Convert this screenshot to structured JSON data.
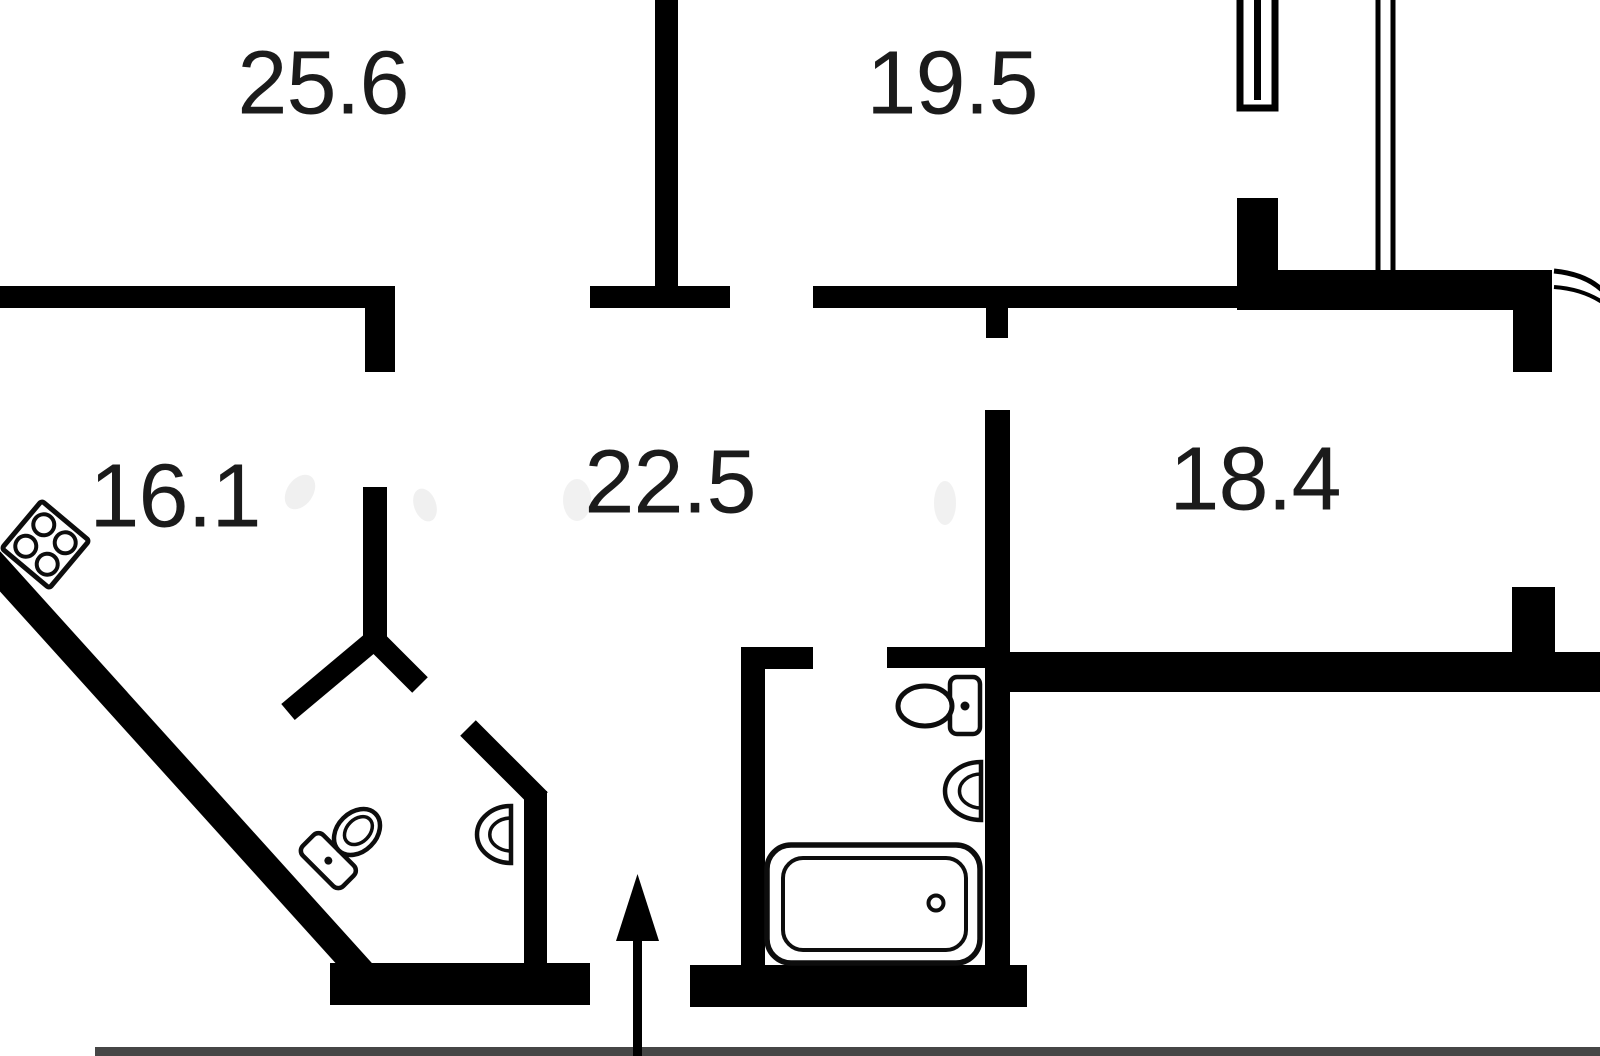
{
  "plan": {
    "type": "apartment-floor-plan",
    "rooms": [
      {
        "id": "room-top-left",
        "area": "25.6"
      },
      {
        "id": "room-top-middle",
        "area": "19.5"
      },
      {
        "id": "kitchen",
        "area": "16.1"
      },
      {
        "id": "hallway",
        "area": "22.5"
      },
      {
        "id": "room-right",
        "area": "18.4"
      }
    ],
    "fixtures": [
      "stove-4-burners",
      "wc-toilet",
      "wc-sink",
      "bathroom-toilet",
      "bathroom-sink",
      "bathtub",
      "entrance-arrow",
      "window-frame",
      "balcony-partition",
      "balcony-door-arc"
    ],
    "colors": {
      "background": "#ffffff",
      "wall": "#000000",
      "label": "#1b1b1b",
      "floor_edge_strip": "#464646"
    }
  }
}
